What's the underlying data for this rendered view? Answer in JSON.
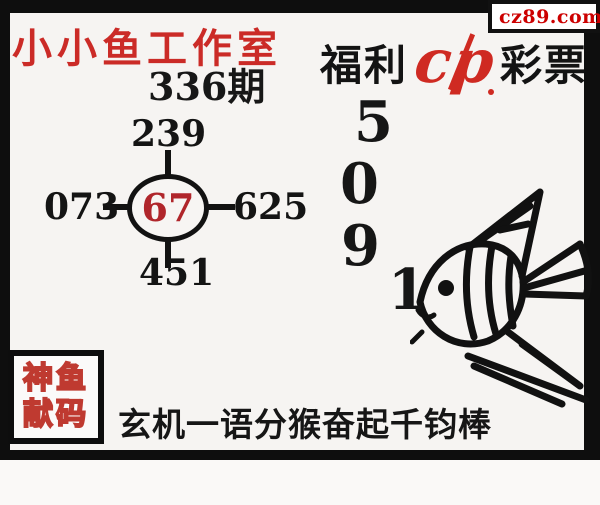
{
  "site_badge": {
    "label": "cz89.com"
  },
  "header": {
    "studio_title": "小小鱼工作室",
    "issue_label": "336期"
  },
  "brand": {
    "prefix": "福利",
    "suffix": "彩票",
    "logo_text": "cp"
  },
  "wheel": {
    "top": "239",
    "left": "073",
    "right": "625",
    "bottom": "451",
    "center": "67"
  },
  "code_digits": {
    "d1": "5",
    "d2": "0",
    "d3": "9",
    "d4": "1"
  },
  "stamp": {
    "line1": "神鱼",
    "line2": "献码"
  },
  "riddle": {
    "text": "玄机一语分猴奋起千钧棒"
  },
  "colors": {
    "accent_red": "#cb2b27",
    "wheel_center_red": "#b0262b",
    "badge_red": "#cc0000",
    "badge_yellow": "#f2e115",
    "logo_red": "#cf2a22",
    "stamp_red": "#bf3a30",
    "ink": "#151515"
  }
}
